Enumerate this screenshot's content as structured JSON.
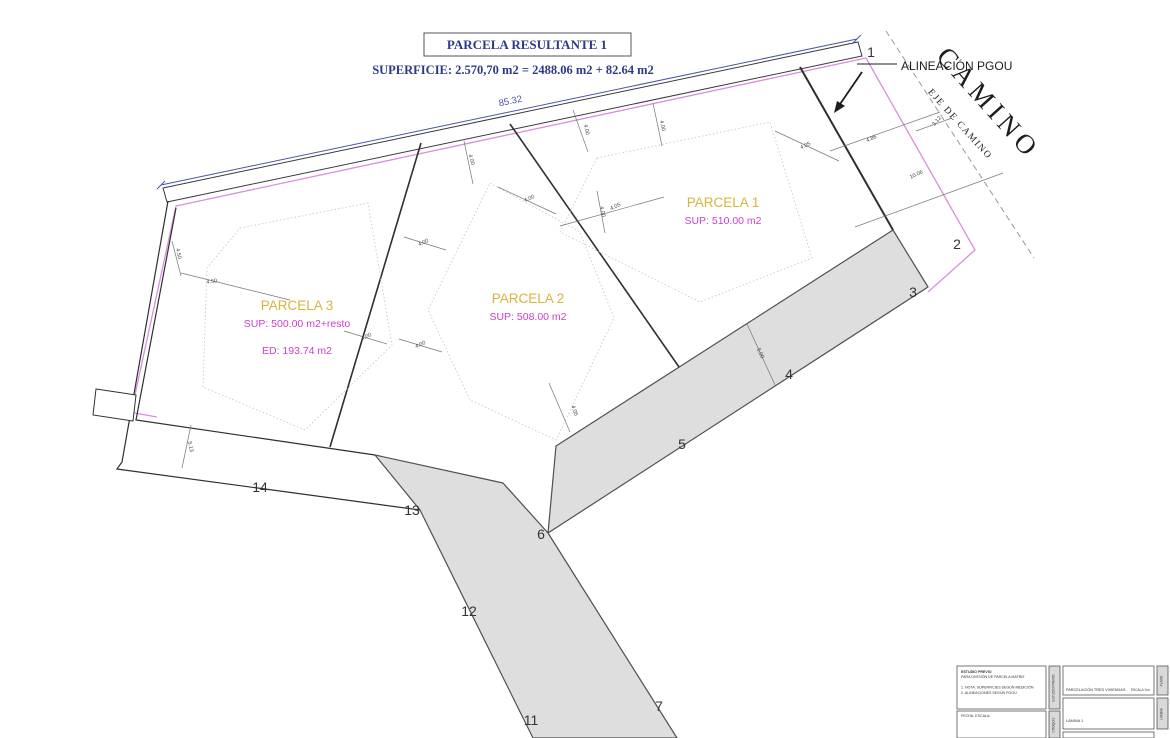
{
  "drawing": {
    "title_box": "PARCELA  RESULTANTE 1",
    "superficie_line": "SUPERFICIE: 2.570,70 m2 =  2488.06 m2 + 82.64 m2",
    "alineacion_label": "ALINEACIÓN PGOU",
    "camino_label": "CAMINO",
    "eje_camino_label": "EJE DE CAMINO",
    "colors": {
      "navy": "#2e3a87",
      "dim_blue": "#4a55a8",
      "magenta_line": "#d98fd9",
      "magenta_text": "#cb3fcb",
      "yellow": "#d6b53c",
      "road_fill": "#dedede",
      "line_black": "#3a3a3a"
    },
    "parcels": [
      {
        "title": "PARCELA 1",
        "x": 723,
        "y": 207,
        "lines": [
          {
            "text": "SUP: 510.00 m2",
            "dy": 17
          }
        ]
      },
      {
        "title": "PARCELA 2",
        "x": 528,
        "y": 303,
        "lines": [
          {
            "text": "SUP: 508.00 m2",
            "dy": 17
          }
        ]
      },
      {
        "title": "PARCELA 3",
        "x": 297,
        "y": 310,
        "lines": [
          {
            "text": "SUP: 500.00 m2+resto",
            "dy": 17
          },
          {
            "text": "ED: 193.74 m2",
            "dy": 44
          }
        ]
      }
    ],
    "vertex_labels": [
      {
        "n": "1",
        "x": 871,
        "y": 57
      },
      {
        "n": "2",
        "x": 957,
        "y": 249
      },
      {
        "n": "3",
        "x": 913,
        "y": 297
      },
      {
        "n": "4",
        "x": 789,
        "y": 379
      },
      {
        "n": "5",
        "x": 682,
        "y": 449
      },
      {
        "n": "6",
        "x": 541,
        "y": 539
      },
      {
        "n": "7",
        "x": 659,
        "y": 711
      },
      {
        "n": "11",
        "x": 531,
        "y": 725
      },
      {
        "n": "12",
        "x": 469,
        "y": 616
      },
      {
        "n": "13",
        "x": 412,
        "y": 515
      },
      {
        "n": "14",
        "x": 260,
        "y": 492
      }
    ],
    "dimensions": [
      {
        "v": "85.32",
        "x": 511,
        "y": 104,
        "r": -11.9,
        "c": "#4a55a8",
        "s": 9.5
      },
      {
        "v": "4.00",
        "x": 585,
        "y": 130,
        "r": 76
      },
      {
        "v": "4.05",
        "x": 616,
        "y": 208,
        "r": -25
      },
      {
        "v": "4.05",
        "x": 806,
        "y": 147,
        "r": -25
      },
      {
        "v": "4.86",
        "x": 872,
        "y": 140,
        "r": -25
      },
      {
        "v": "3.12",
        "x": 938,
        "y": 122,
        "r": -50
      },
      {
        "v": "10.06",
        "x": 917,
        "y": 176,
        "r": -25
      },
      {
        "v": "4.00",
        "x": 470,
        "y": 160,
        "r": 74
      },
      {
        "v": "4.00",
        "x": 530,
        "y": 200,
        "r": -25
      },
      {
        "v": "4.00",
        "x": 424,
        "y": 244,
        "r": -25
      },
      {
        "v": "4.00",
        "x": 367,
        "y": 338,
        "r": -25
      },
      {
        "v": "4.00",
        "x": 421,
        "y": 346,
        "r": -25
      },
      {
        "v": "4.50",
        "x": 212,
        "y": 283,
        "r": -8
      },
      {
        "v": "5.13",
        "x": 189,
        "y": 447,
        "r": 78
      },
      {
        "v": "4.05",
        "x": 573,
        "y": 411,
        "r": 72
      },
      {
        "v": "5.00",
        "x": 759,
        "y": 354,
        "r": 64
      },
      {
        "v": "4.00",
        "x": 601,
        "y": 212,
        "r": 78
      },
      {
        "v": "4.00",
        "x": 661,
        "y": 126,
        "r": 78
      },
      {
        "v": "4.50",
        "x": 177,
        "y": 254,
        "r": 78
      }
    ]
  },
  "title_block": {
    "left_box_lines": [
      "ESTUDIO PREVIO",
      "PARA DIVISIÓN DE PARCELA MATRIZ",
      "",
      "1. NOTA: SUPERFICIES SEGÚN MEDICIÓN",
      "2. ALINEACIONES SEGÚN PGOU"
    ],
    "left_box2_line": "FECHA:              ESCALA:",
    "right_box1_main": "PARCELACIÓN TRES VIVIENDAS",
    "right_box1_small": "ESCALA 1/m",
    "right_box2_line": "LÁMINA 1",
    "strip_labels": [
      "ESTUDIO PREVIO",
      "CROQUIS",
      "PLANO",
      "LÁMINA"
    ]
  }
}
